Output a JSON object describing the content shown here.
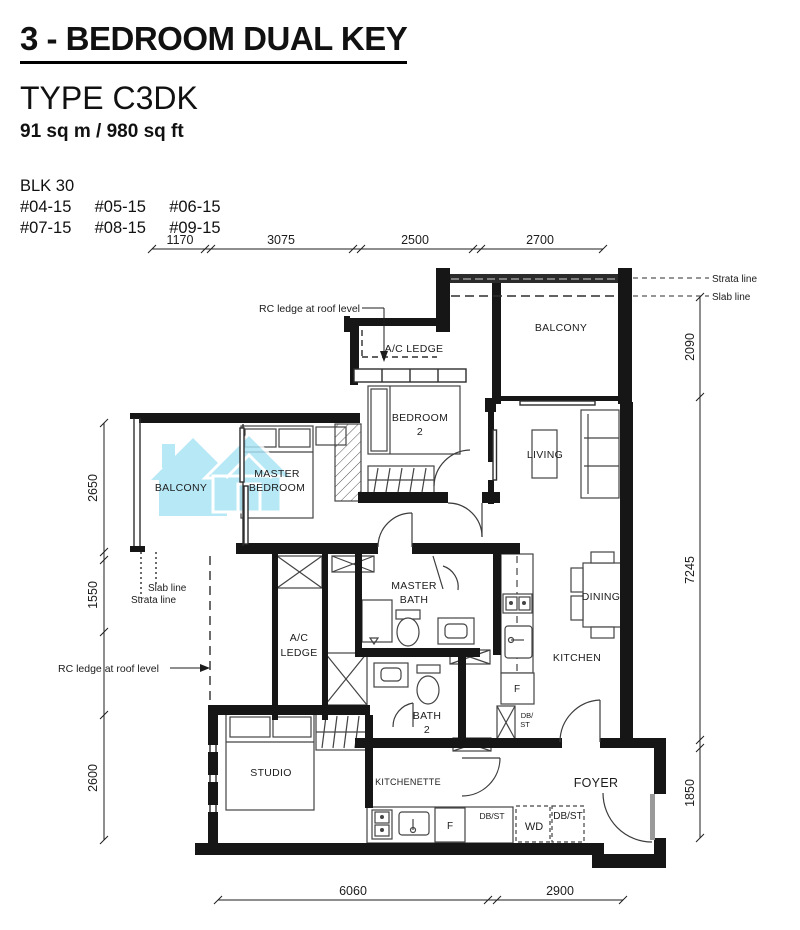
{
  "header": {
    "title": "3 - BEDROOM DUAL KEY",
    "type": "TYPE C3DK",
    "area": "91 sq m / 980 sq ft",
    "block": "BLK 30",
    "units_row1": [
      "#04-15",
      "#05-15",
      "#06-15"
    ],
    "units_row2": [
      "#07-15",
      "#08-15",
      "#09-15"
    ]
  },
  "dimensions": {
    "top": [
      "1170",
      "3075",
      "2500",
      "2700"
    ],
    "right": [
      "2090",
      "7245",
      "1850"
    ],
    "left": [
      "2650",
      "1550",
      "2600"
    ],
    "bottom": [
      "6060",
      "2900"
    ]
  },
  "annotations": {
    "strata_line_right": "Strata line",
    "slab_line_right": "Slab line",
    "rc_ledge_top": "RC ledge at roof level",
    "slab_line_left": "Slab line",
    "strata_line_left": "Strata line",
    "rc_ledge_left": "RC ledge at roof level"
  },
  "rooms": {
    "ac_ledge_top": "A/C LEDGE",
    "balcony_top": "BALCONY",
    "bedroom2_l1": "BEDROOM",
    "bedroom2_l2": "2",
    "living": "LIVING",
    "balcony_left": "BALCONY",
    "master_bedroom_l1": "MASTER",
    "master_bedroom_l2": "BEDROOM",
    "master_bath_l1": "MASTER",
    "master_bath_l2": "BATH",
    "dining": "DINING",
    "kitchen": "KITCHEN",
    "ac_ledge_left_l1": "A/C",
    "ac_ledge_left_l2": "LEDGE",
    "bath2_l1": "BATH",
    "bath2_l2": "2",
    "studio": "STUDIO",
    "kitchenette": "KITCHENETTE",
    "foyer": "FOYER"
  },
  "appliances": {
    "fridge_kitchen": "F",
    "dbst_kitchen_l1": "DB/",
    "dbst_kitchen_l2": "ST",
    "fridge_kitchenette": "F",
    "dbst_kitchenette": "DB/ST",
    "washer_dryer": "WD",
    "dbst_foyer": "DB/ST"
  },
  "colors": {
    "wall": "#161616",
    "line": "#3c3c3c",
    "watermark_blue": "#a8e3f5"
  }
}
